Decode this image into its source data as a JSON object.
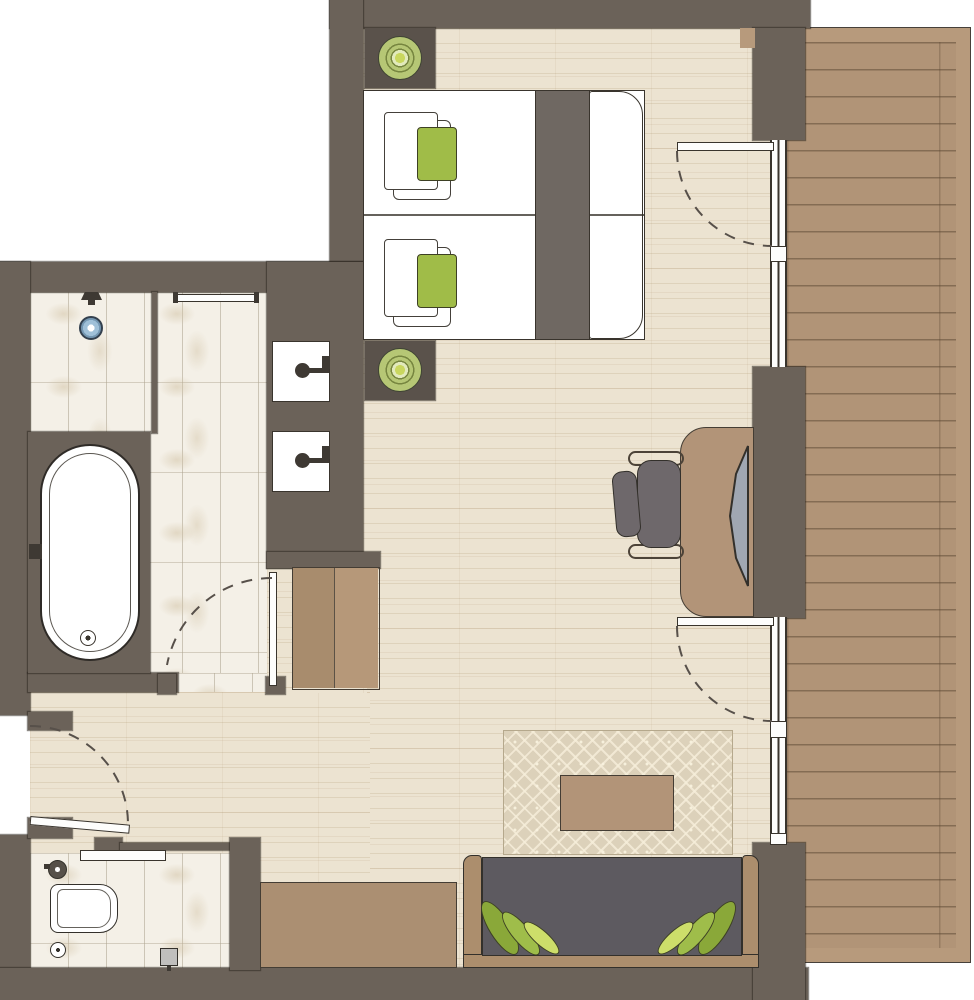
{
  "diagram": {
    "type": "floor-plan",
    "description": "Top-down architectural floor plan of a hotel room with balcony",
    "rooms": [
      {
        "name": "bedroom",
        "features": [
          "twin-beds",
          "nightstands",
          "table-lamps"
        ]
      },
      {
        "name": "bathroom",
        "features": [
          "bathtub",
          "walk-in-shower",
          "double-sinks",
          "floor-drain"
        ]
      },
      {
        "name": "wc",
        "features": [
          "toilet",
          "hand-shower",
          "toilet-paper-holder",
          "sliding-door"
        ]
      },
      {
        "name": "hallway",
        "features": [
          "entry-door",
          "wardrobe"
        ]
      },
      {
        "name": "living-area",
        "features": [
          "desk",
          "monitor",
          "office-chair",
          "rug",
          "coffee-table",
          "sofa",
          "leaf-pillows",
          "sideboard"
        ]
      },
      {
        "name": "balcony",
        "features": [
          "wood-decking",
          "two-glass-doors"
        ]
      }
    ],
    "counts": {
      "beds": 2,
      "sinks": 2,
      "doors_swing": 4,
      "doors_sliding": 1,
      "sofa_pillows": 6,
      "lamps": 2
    }
  },
  "palette": {
    "wall": "#6b6259",
    "nstand": "#5a524b",
    "floor": "#ece3d1",
    "tile": "#f4f0e7",
    "deck": "#b19477",
    "deckBorder": "#b79a7c",
    "glasswhite": "#fdfdfc",
    "tan": "#b29478",
    "sideboardtan": "#ab8f72",
    "wardrobeL": "#a88c6d",
    "wardrobeR": "#b69879",
    "sofatan": "#ac8e6d",
    "sofagray": "#5d5a60",
    "runner": "#6f6862",
    "chairgray": "#6e686b",
    "monitor": "#a0a7b2",
    "bedwhite": "#ffffff",
    "green": "#a0bc48",
    "greendark": "#8aa839",
    "greenmid": "#9fbd4a",
    "greenlight": "#cdde6a",
    "lampgreen": "#b6c775",
    "lamplight": "#e2eabc",
    "lampcenter": "#c9d75f",
    "drainblue": "#9fc0d8",
    "rugbase": "#dcd1ba",
    "toiletgray": "#c0bfbd",
    "linedark": "#39342d",
    "arcdash": "#57504a"
  }
}
